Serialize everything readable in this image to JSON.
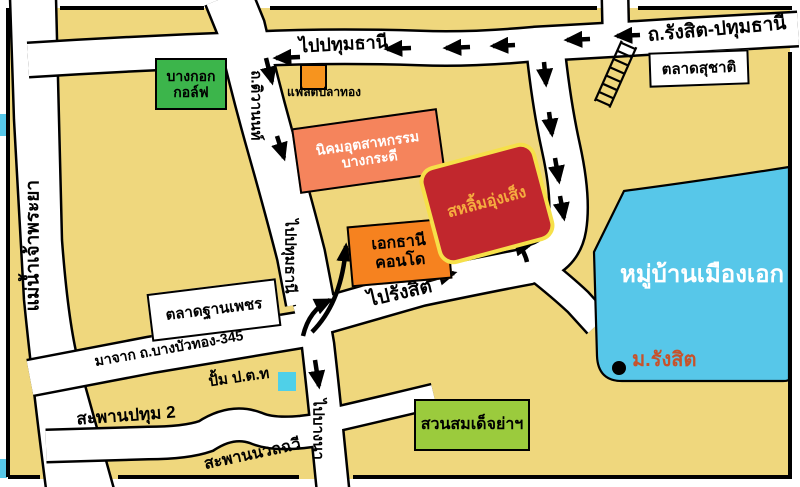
{
  "colors": {
    "background": "#EFD77D",
    "road": "#FFFFFF",
    "outline": "#000000",
    "water_blue": "#57C7E9",
    "village_blue": "#57C7E9",
    "golf_green": "#3CB54B",
    "park_green": "#9BCB3D",
    "industrial_salmon": "#F5845C",
    "condo_orange": "#F6821F",
    "flat_orange": "#F7941E",
    "destination_red": "#C1272D",
    "destination_border": "#F6E049",
    "destination_text": "#F5AC3F",
    "rangsit_univ_text": "#C7522B",
    "pump_cyan": "#4FD0E8"
  },
  "labels": {
    "river": "แม่น้ำเจ้าพระยา",
    "to_pathumthani_top": "ไปปทุมธานี",
    "rangsit_pathumthani_road": "ถ.รังสิต-ปทุมธานี",
    "suchat_market": "ตลาดสุชาติ",
    "bangkok_golf_line1": "บางกอก",
    "bangkok_golf_line2": "กอล์ฟ",
    "tiwanon_road": "ถ.ติวานนท์",
    "flat_plathong": "แฟลตปลาทอง",
    "industrial_line1": "นิคมอุตสาหกรรม",
    "industrial_line2": "บางกระดี",
    "ekthani_line1": "เอกธานี",
    "ekthani_line2": "คอนโด",
    "destination": "สหลิ้มอุ่งเส็ง",
    "to_pathumthani_vertical": "ไปปทุมธานี",
    "to_rangsit": "ไปรังสิต",
    "muang_ake_village": "หมู่บ้านเมืองเอก",
    "rangsit_university": "ม.รังสิต",
    "thanphet_market": "ตลาดฐานเพชร",
    "from_bangbuathong_345": "มาจาก ถ.บางบัวทอง-345",
    "ptt_pump": "ปั้ม ป.ต.ท",
    "pathum2_bridge": "สะพานปทุม 2",
    "to_bangna": "ไปบางนา",
    "nuanchawee_bridge": "สะพานนวลฉวี",
    "suan_somdet": "สวนสมเด็จย่าฯ"
  }
}
